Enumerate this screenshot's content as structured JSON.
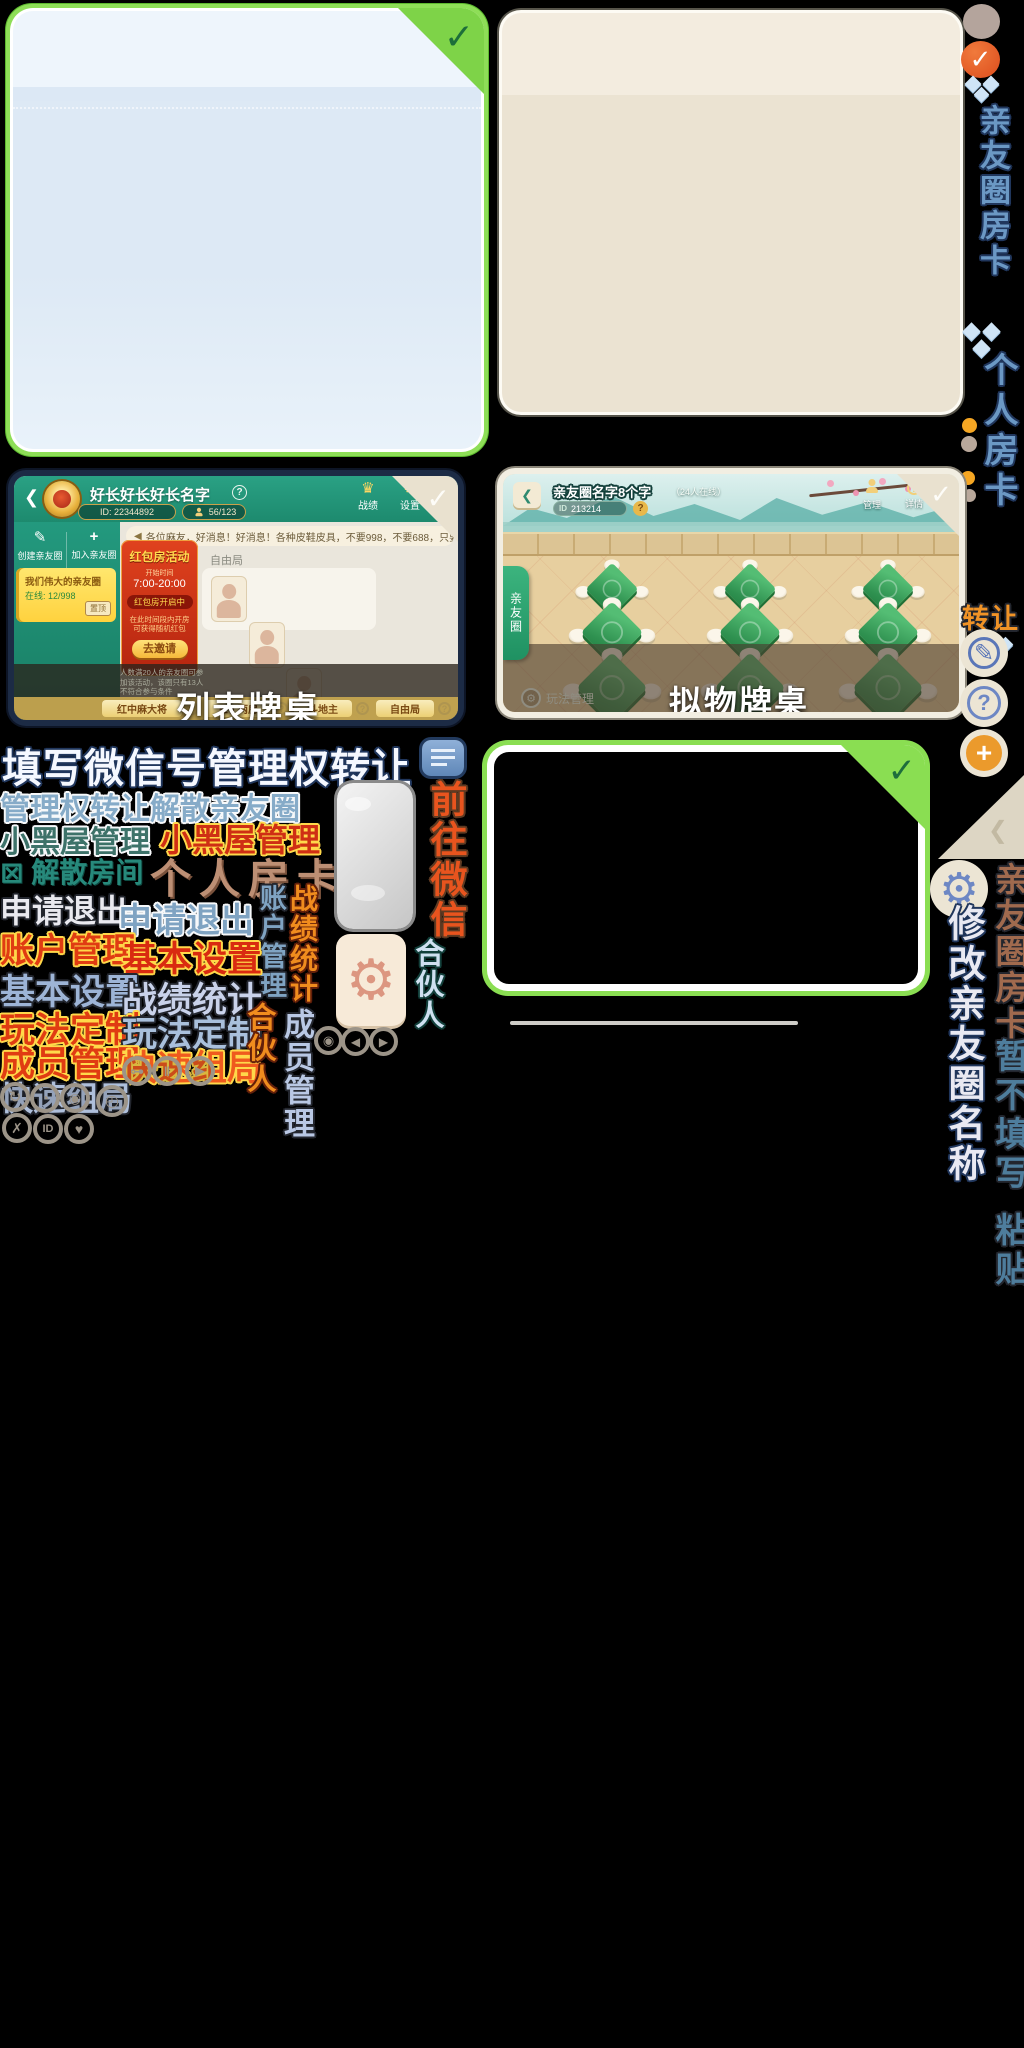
{
  "glyphs": {
    "check": "✓",
    "chevron_left": "❮",
    "gear": "⚙",
    "pencil": "✎",
    "question": "?",
    "plus": "+",
    "key": "⊶",
    "pause": "‖",
    "play": "▶",
    "redo": "↻",
    "pie": "◔",
    "eye": "◉",
    "clock": "◴",
    "cross": "✗",
    "id": "ID",
    "heart": "♥",
    "sound": "◀",
    "back": "❮",
    "trophy": "♛",
    "dissolve": "⊠"
  },
  "rail": {
    "friend_card": "亲友圈房卡",
    "personal_card": "个人房卡",
    "transfer": "转让",
    "friend_card_brown": "亲友圈房卡",
    "no_fill": "暂不填写",
    "paste": "粘贴",
    "rename": "修改亲友圈名称"
  },
  "sprites": {
    "fill_wechat": "填写微信号管理权转让",
    "transfer_dissolve": "管理权转让解散亲友圈",
    "blackroom_a": "小黑屋管理",
    "blackroom_b": "小黑屋管理",
    "dissolve_room": "解散房间",
    "personal_card": "个人房卡",
    "quit_a": "申请退出",
    "quit_b": "申请退出",
    "account_v": "账户管理",
    "stats_v": "战绩统计",
    "account_h": "账户管理",
    "basic_a": "基本设置",
    "basic_b": "基本设置",
    "stats_h": "战绩统计",
    "custom_a": "玩法定制",
    "custom_b": "玩法定制",
    "member_h": "成员管理",
    "quick_a": "快速组局",
    "quick_b": "快速组局",
    "partner_v_a": "合伙人",
    "member_v": "成员管理",
    "partner_v_b": "合伙人",
    "goto_wechat": "前往微信"
  },
  "list_room": {
    "caption": "列表牌桌",
    "title": "好长好长好长名字",
    "help": "?",
    "room_id": "ID: 22344892",
    "members": "56/123",
    "stats": "战绩",
    "settings": "设置",
    "messages": "消息",
    "marquee": "各位麻友，好消息！好消息！各种皮鞋皮具，不要998，不要688，只要98元，只要98元",
    "create": "创建亲友圈",
    "join": "加入亲友圈",
    "my_circle": "我们伟大的亲友圈",
    "online": "在线: 12/998",
    "pin": "置顶",
    "free_mode": "自由局",
    "banner_title": "红包房活动",
    "banner_time_label": "开始时间",
    "banner_time": "7:00-20:00",
    "banner_status": "红包房开启中",
    "banner_desc": "在此时间段内开房可获得随机红包",
    "banner_btn": "去邀请",
    "banner_note": "人数满20人的亲友圈可参加该活动，该圈只有13人不符合参与条件",
    "tabs": [
      {
        "label": "红中麻大将",
        "badge": "?"
      },
      {
        "label": "三丁两房",
        "badge": "?"
      },
      {
        "label": "斗地主",
        "badge": "?"
      },
      {
        "label": "自由局",
        "badge": "?"
      }
    ]
  },
  "sim_room": {
    "caption": "拟物牌桌",
    "title": "亲友圈名字8个字",
    "subtitle": "（24人在线）",
    "id_label": "ID",
    "id_value": "213214",
    "help": "?",
    "manage": "管理",
    "details": "详情",
    "stats": "战绩",
    "side_tab": "亲友圈",
    "manage_play": "玩法管理"
  }
}
